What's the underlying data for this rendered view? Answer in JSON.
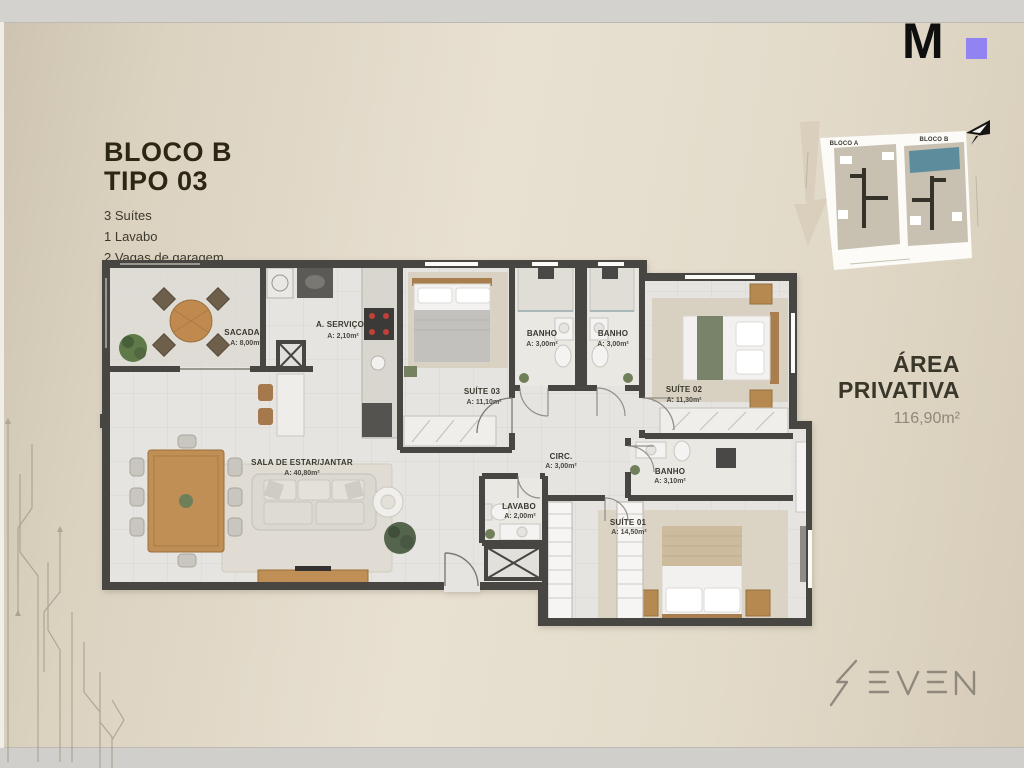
{
  "header": {
    "title_line1": "BLOCO B",
    "title_line2": "TIPO 03",
    "specs": [
      "3 Suítes",
      "1 Lavabo",
      "2 Vagas de garagem"
    ]
  },
  "logo_m": {
    "letter": "M",
    "accent_color": "#9183f1"
  },
  "site_plan": {
    "bloco_a": "BLOCO A",
    "bloco_b": "BLOCO B",
    "highlight_color": "#5d8d9c"
  },
  "area_privativa": {
    "line1": "ÁREA",
    "line2": "PRIVATIVA",
    "value": "116,90m²"
  },
  "brand": {
    "name": "SEVEN"
  },
  "floor_plan": {
    "rooms": [
      {
        "id": "sacada",
        "name": "SACADA",
        "area": "A: 8,00m²"
      },
      {
        "id": "servico",
        "name": "A. SERVIÇO",
        "area": "A: 2,10m²"
      },
      {
        "id": "suite03",
        "name": "SUÍTE 03",
        "area": "A: 11,10m²"
      },
      {
        "id": "banho1",
        "name": "BANHO",
        "area": "A: 3,00m²"
      },
      {
        "id": "banho2",
        "name": "BANHO",
        "area": "A: 3,00m²"
      },
      {
        "id": "suite02",
        "name": "SUÍTE 02",
        "area": "A: 11,30m²"
      },
      {
        "id": "sala",
        "name": "SALA DE ESTAR/JANTAR",
        "area": "A: 40,80m²"
      },
      {
        "id": "circ",
        "name": "CIRC.",
        "area": "A: 3,00m²"
      },
      {
        "id": "lavabo",
        "name": "LAVABO",
        "area": "A: 2,00m²"
      },
      {
        "id": "banho3",
        "name": "BANHO",
        "area": "A: 3,10m²"
      },
      {
        "id": "suite01",
        "name": "SUÍTE 01",
        "area": "A: 14,50m²"
      }
    ]
  }
}
